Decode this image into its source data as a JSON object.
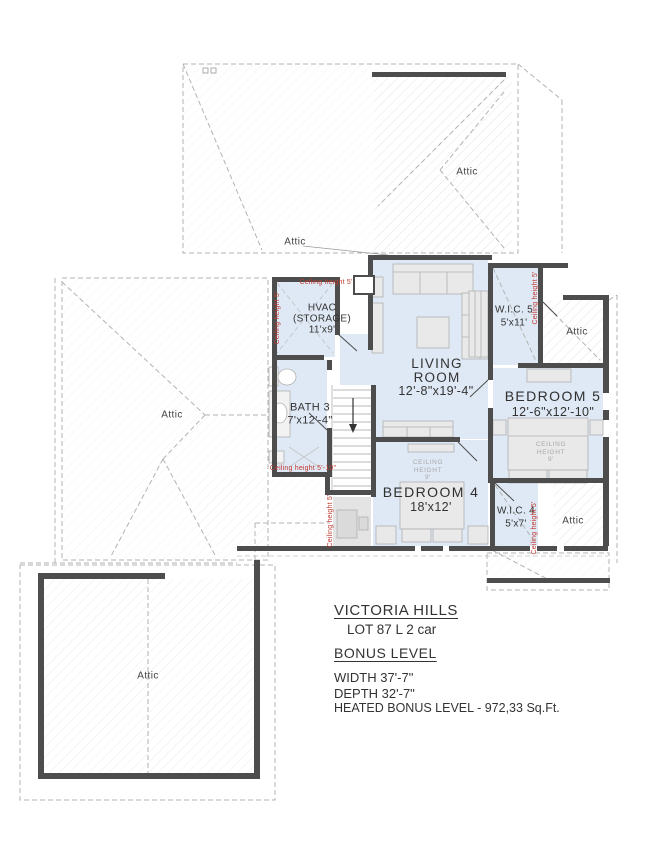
{
  "plan": {
    "attic_label": "Attic",
    "rooms": {
      "living": {
        "l1": "LIVING",
        "l2": "ROOM",
        "dims": "12'-8\"x19'-4\""
      },
      "bedroom5": {
        "name": "BEDROOM 5",
        "dims": "12'-6\"x12'-10\""
      },
      "bedroom4": {
        "name": "BEDROOM 4",
        "dims": "18'x12'"
      },
      "bath3": {
        "name": "BATH 3",
        "dims": "7'x12'-4\""
      },
      "hvac": {
        "l1": "HVAC",
        "l2": "(STORAGE)",
        "dims": "11'x9'"
      },
      "wic5": {
        "name": "W.I.C. 5",
        "dims": "5'x11'"
      },
      "wic4": {
        "name": "W.I.C. 4",
        "dims": "5'x7'"
      }
    },
    "ceiling9": {
      "l1": "CEILING",
      "l2": "HEIGHT",
      "l3": "9'"
    },
    "notes": {
      "ch5": "Ceiling height 5'",
      "ch510": "Ceiling height 5'-10\""
    },
    "colors": {
      "wall": "#4d4d4d",
      "room_fill": "#dfe9f5",
      "roof_dash": "#b3b3b3",
      "note_red": "#c13a31"
    }
  },
  "title_block": {
    "project": "VICTORIA HILLS",
    "lot": "LOT 87 L 2 car",
    "level": "BONUS LEVEL",
    "width": "WIDTH 37'-7\"",
    "depth": "DEPTH 32'-7\"",
    "heated": "HEATED BONUS LEVEL - 972,33 Sq.Ft."
  }
}
